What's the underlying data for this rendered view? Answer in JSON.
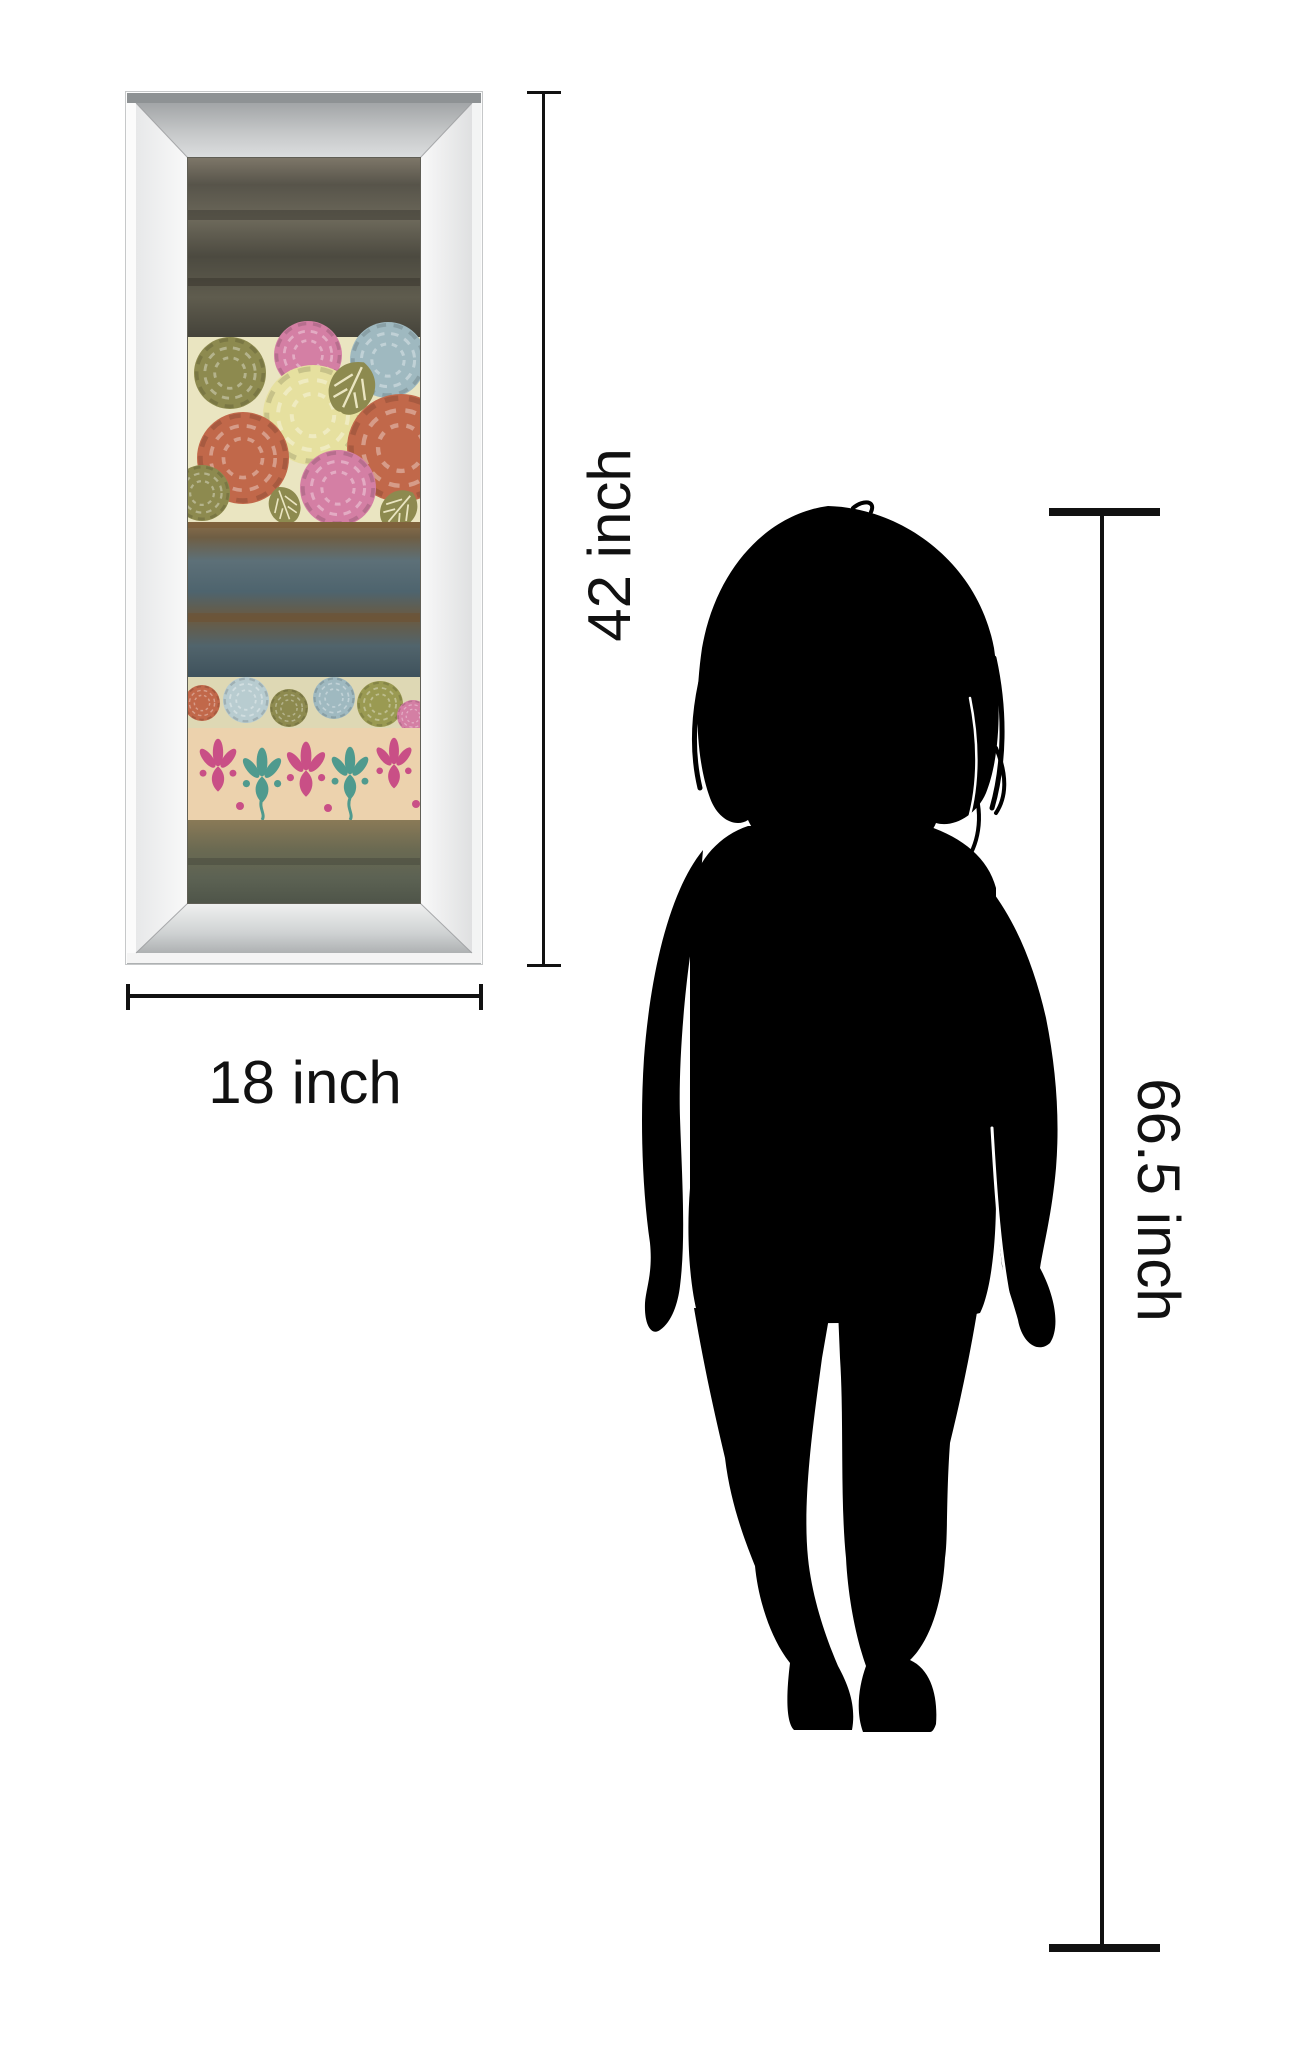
{
  "image": {
    "type": "product size comparison diagram",
    "subject": "mirror-framed striped floral art print next to woman silhouette"
  },
  "dimensions": {
    "art_height_label": "42 inch",
    "art_width_label": "18 inch",
    "person_height_label": "66.5 inch"
  },
  "colors": {
    "background": "#ffffff",
    "dimension_line": "#111111",
    "label_text": "#111111",
    "silhouette": "#000000",
    "frame_white": "#fbfbfb",
    "frame_bevel_gray": "#b9bcbd",
    "art_band_dark_olive": "#57544a",
    "art_band_floral_bg": "#eae5c1",
    "art_band_watercolor_blue": "#4e646e",
    "art_band_small_floral_bg": "#ded8b4",
    "art_band_damask_bg": "#ecd2ad",
    "art_band_bottom_olive": "#5c6253",
    "flower_orange": "#c1684a",
    "flower_pink": "#d47fa4",
    "flower_olive": "#8d8a4f",
    "flower_blue": "#9fb9c0",
    "flower_cream": "#e6e09f",
    "damask_pink": "#c94f86",
    "damask_teal": "#4f9a8e"
  }
}
